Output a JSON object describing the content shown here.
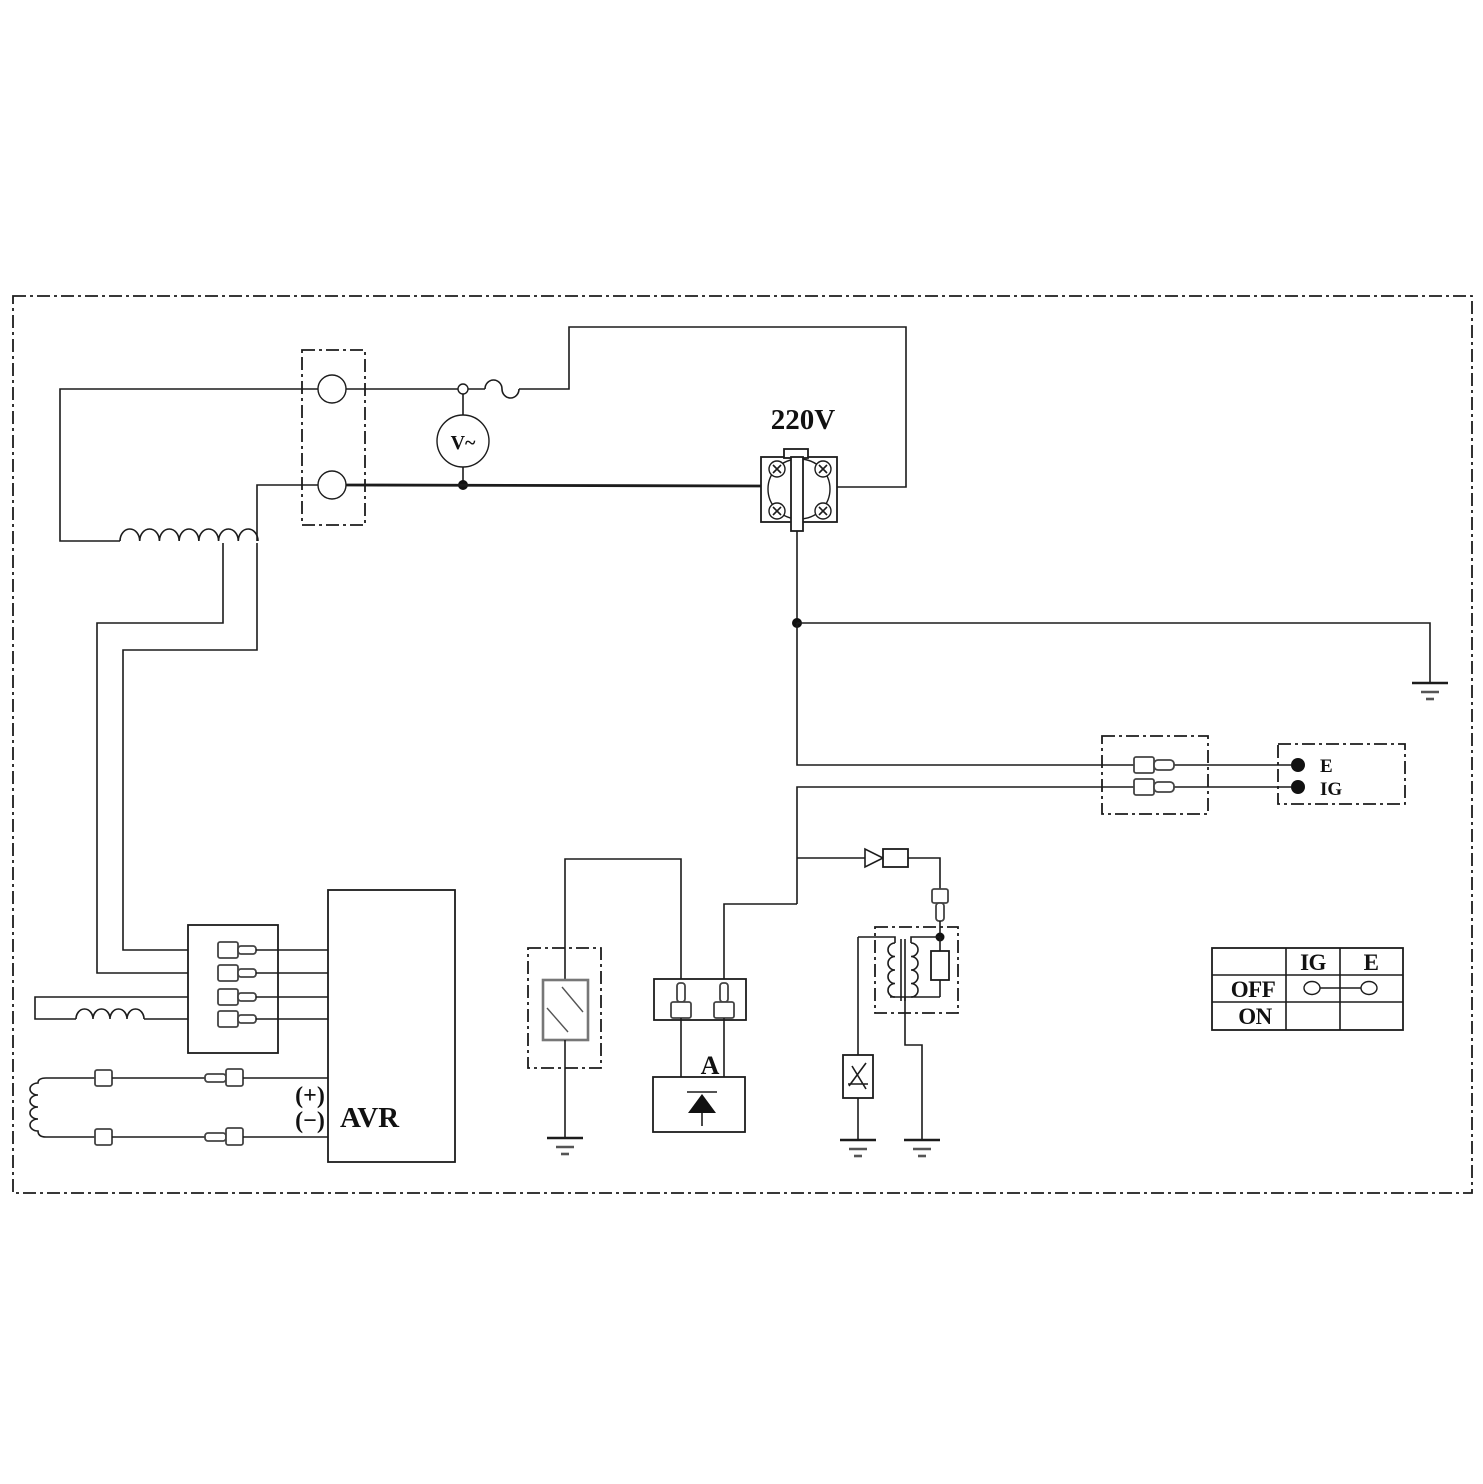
{
  "labels": {
    "outlet_voltage": "220V",
    "voltmeter": "V~",
    "avr": "AVR",
    "avr_plus": "(+)",
    "avr_minus": "(−)",
    "ignition_unit": "A",
    "stop_switch_e": "E",
    "stop_switch_ig": "IG"
  },
  "switch_table": {
    "col_ig": "IG",
    "col_e": "E",
    "row_off": "OFF",
    "row_on": "ON",
    "off_row_ig_e_connected": true,
    "on_row_ig_e_connected": false
  },
  "symbols": {
    "voltmeter": "ac-voltmeter-circle-V~",
    "breaker": "fuse-breaker-squiggle",
    "outlet": "220v-round-socket-with-screws",
    "ground": "earth-ground-three-bars",
    "stator_winding": "coil-7-humps",
    "sub_winding": "coil-4-humps",
    "field_winding": "vertical-coil-4-humps",
    "ignition_coil": "transformer-with-resistor",
    "spark_plug": "spark-gap-box",
    "oil_sensor": "hatched-rectangle-unit",
    "diode": "triangle-diode",
    "connectors": "bullet-terminal"
  },
  "colors": {
    "line": "#1c1c1c",
    "background": "#ffffff",
    "text": "#111111"
  }
}
